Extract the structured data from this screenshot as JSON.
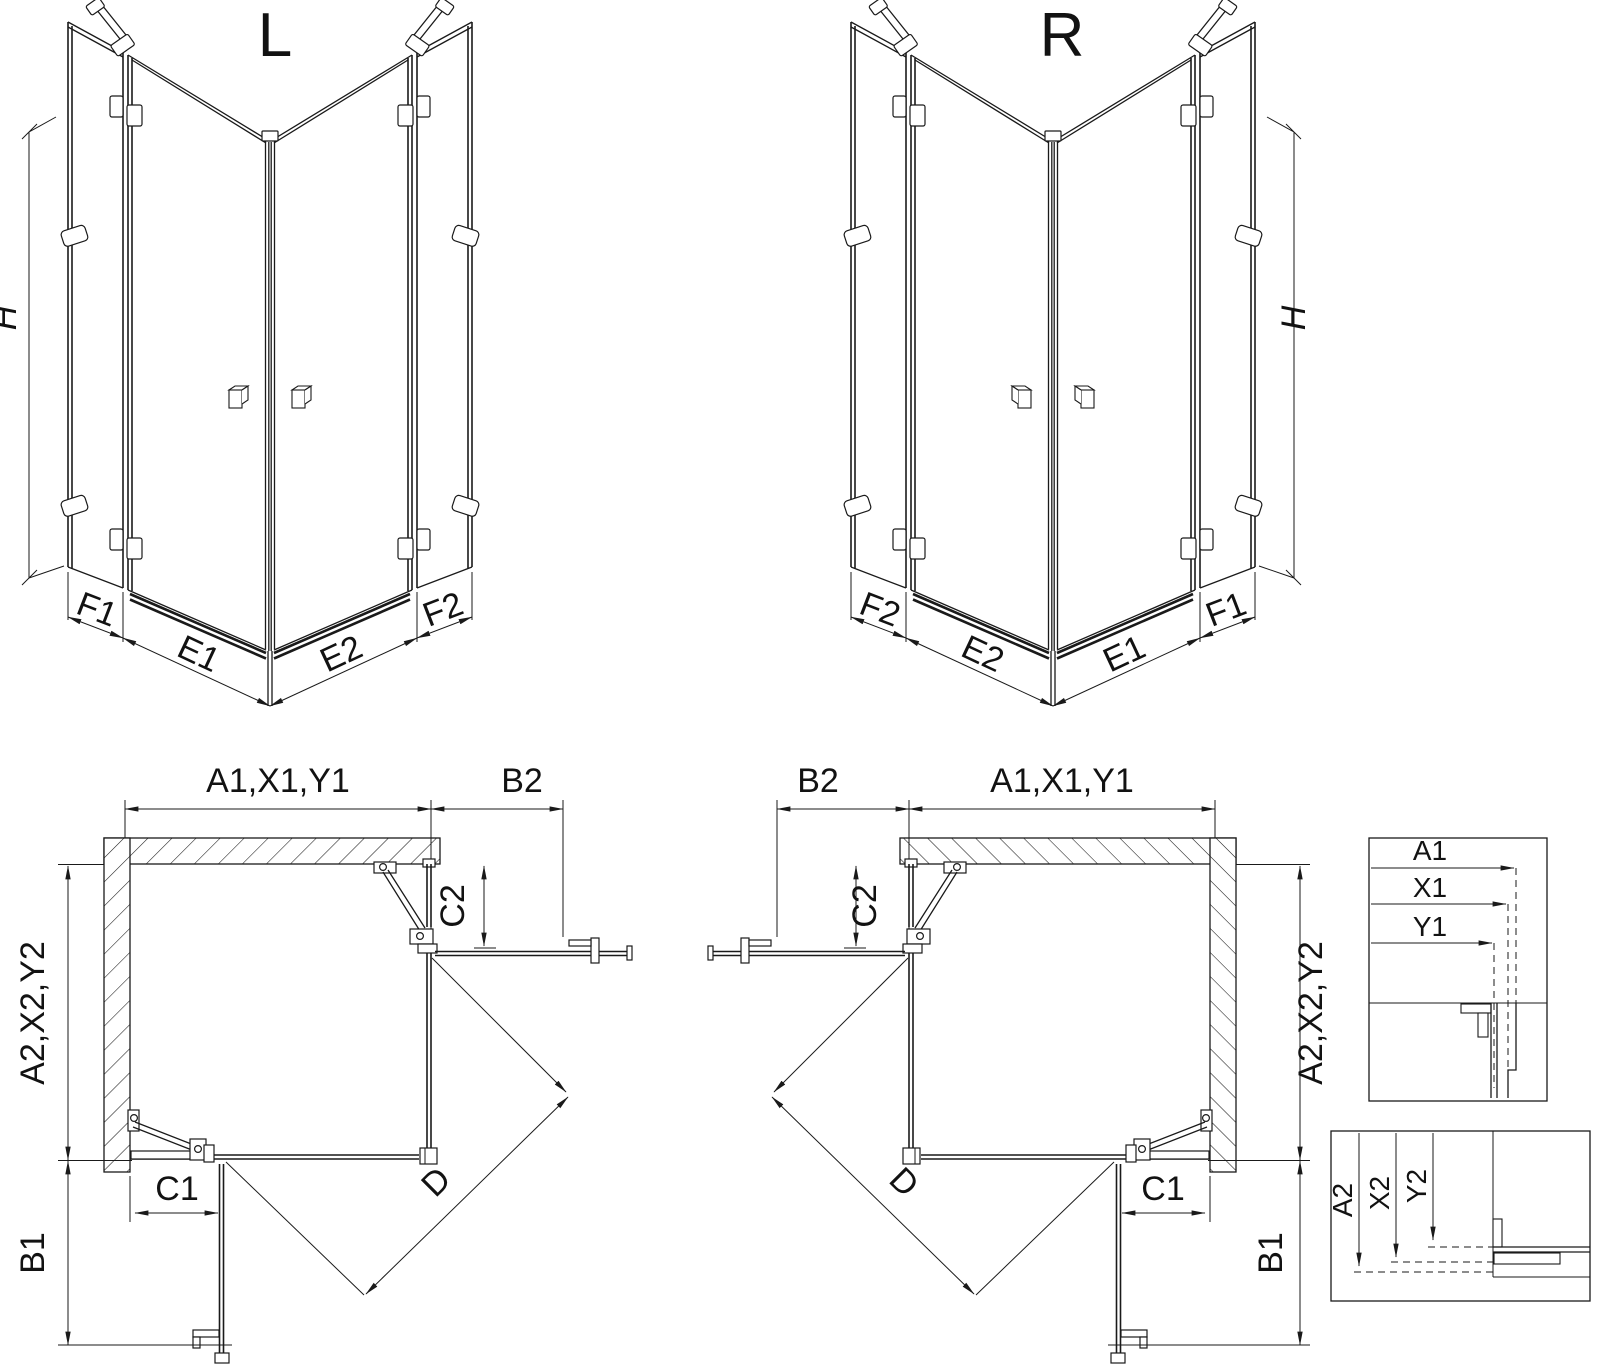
{
  "drawing": {
    "background_color": "#ffffff",
    "line_color": "#1a1a1a",
    "iso_left": {
      "title": "L",
      "dim_height": "H",
      "dims_bottom": [
        "F1",
        "E1",
        "E2",
        "F2"
      ]
    },
    "iso_right": {
      "title": "R",
      "dim_height": "H",
      "dims_bottom": [
        "F2",
        "E2",
        "E1",
        "F1"
      ]
    },
    "plan_left": {
      "dim_top_a": "A1,X1,Y1",
      "dim_top_b": "B2",
      "dim_c2": "C2",
      "dim_side": "A2,X2,Y2",
      "dim_c1": "C1",
      "dim_b1": "B1",
      "dim_d": "D"
    },
    "plan_right": {
      "dim_top_a": "A1,X1,Y1",
      "dim_top_b": "B2",
      "dim_c2": "C2",
      "dim_side": "A2,X2,Y2",
      "dim_c1": "C1",
      "dim_b1": "B1",
      "dim_d": "D"
    },
    "detail_top": {
      "rows": [
        "A1",
        "X1",
        "Y1"
      ]
    },
    "detail_bottom": {
      "rows": [
        "A2",
        "X2",
        "Y2"
      ]
    }
  }
}
